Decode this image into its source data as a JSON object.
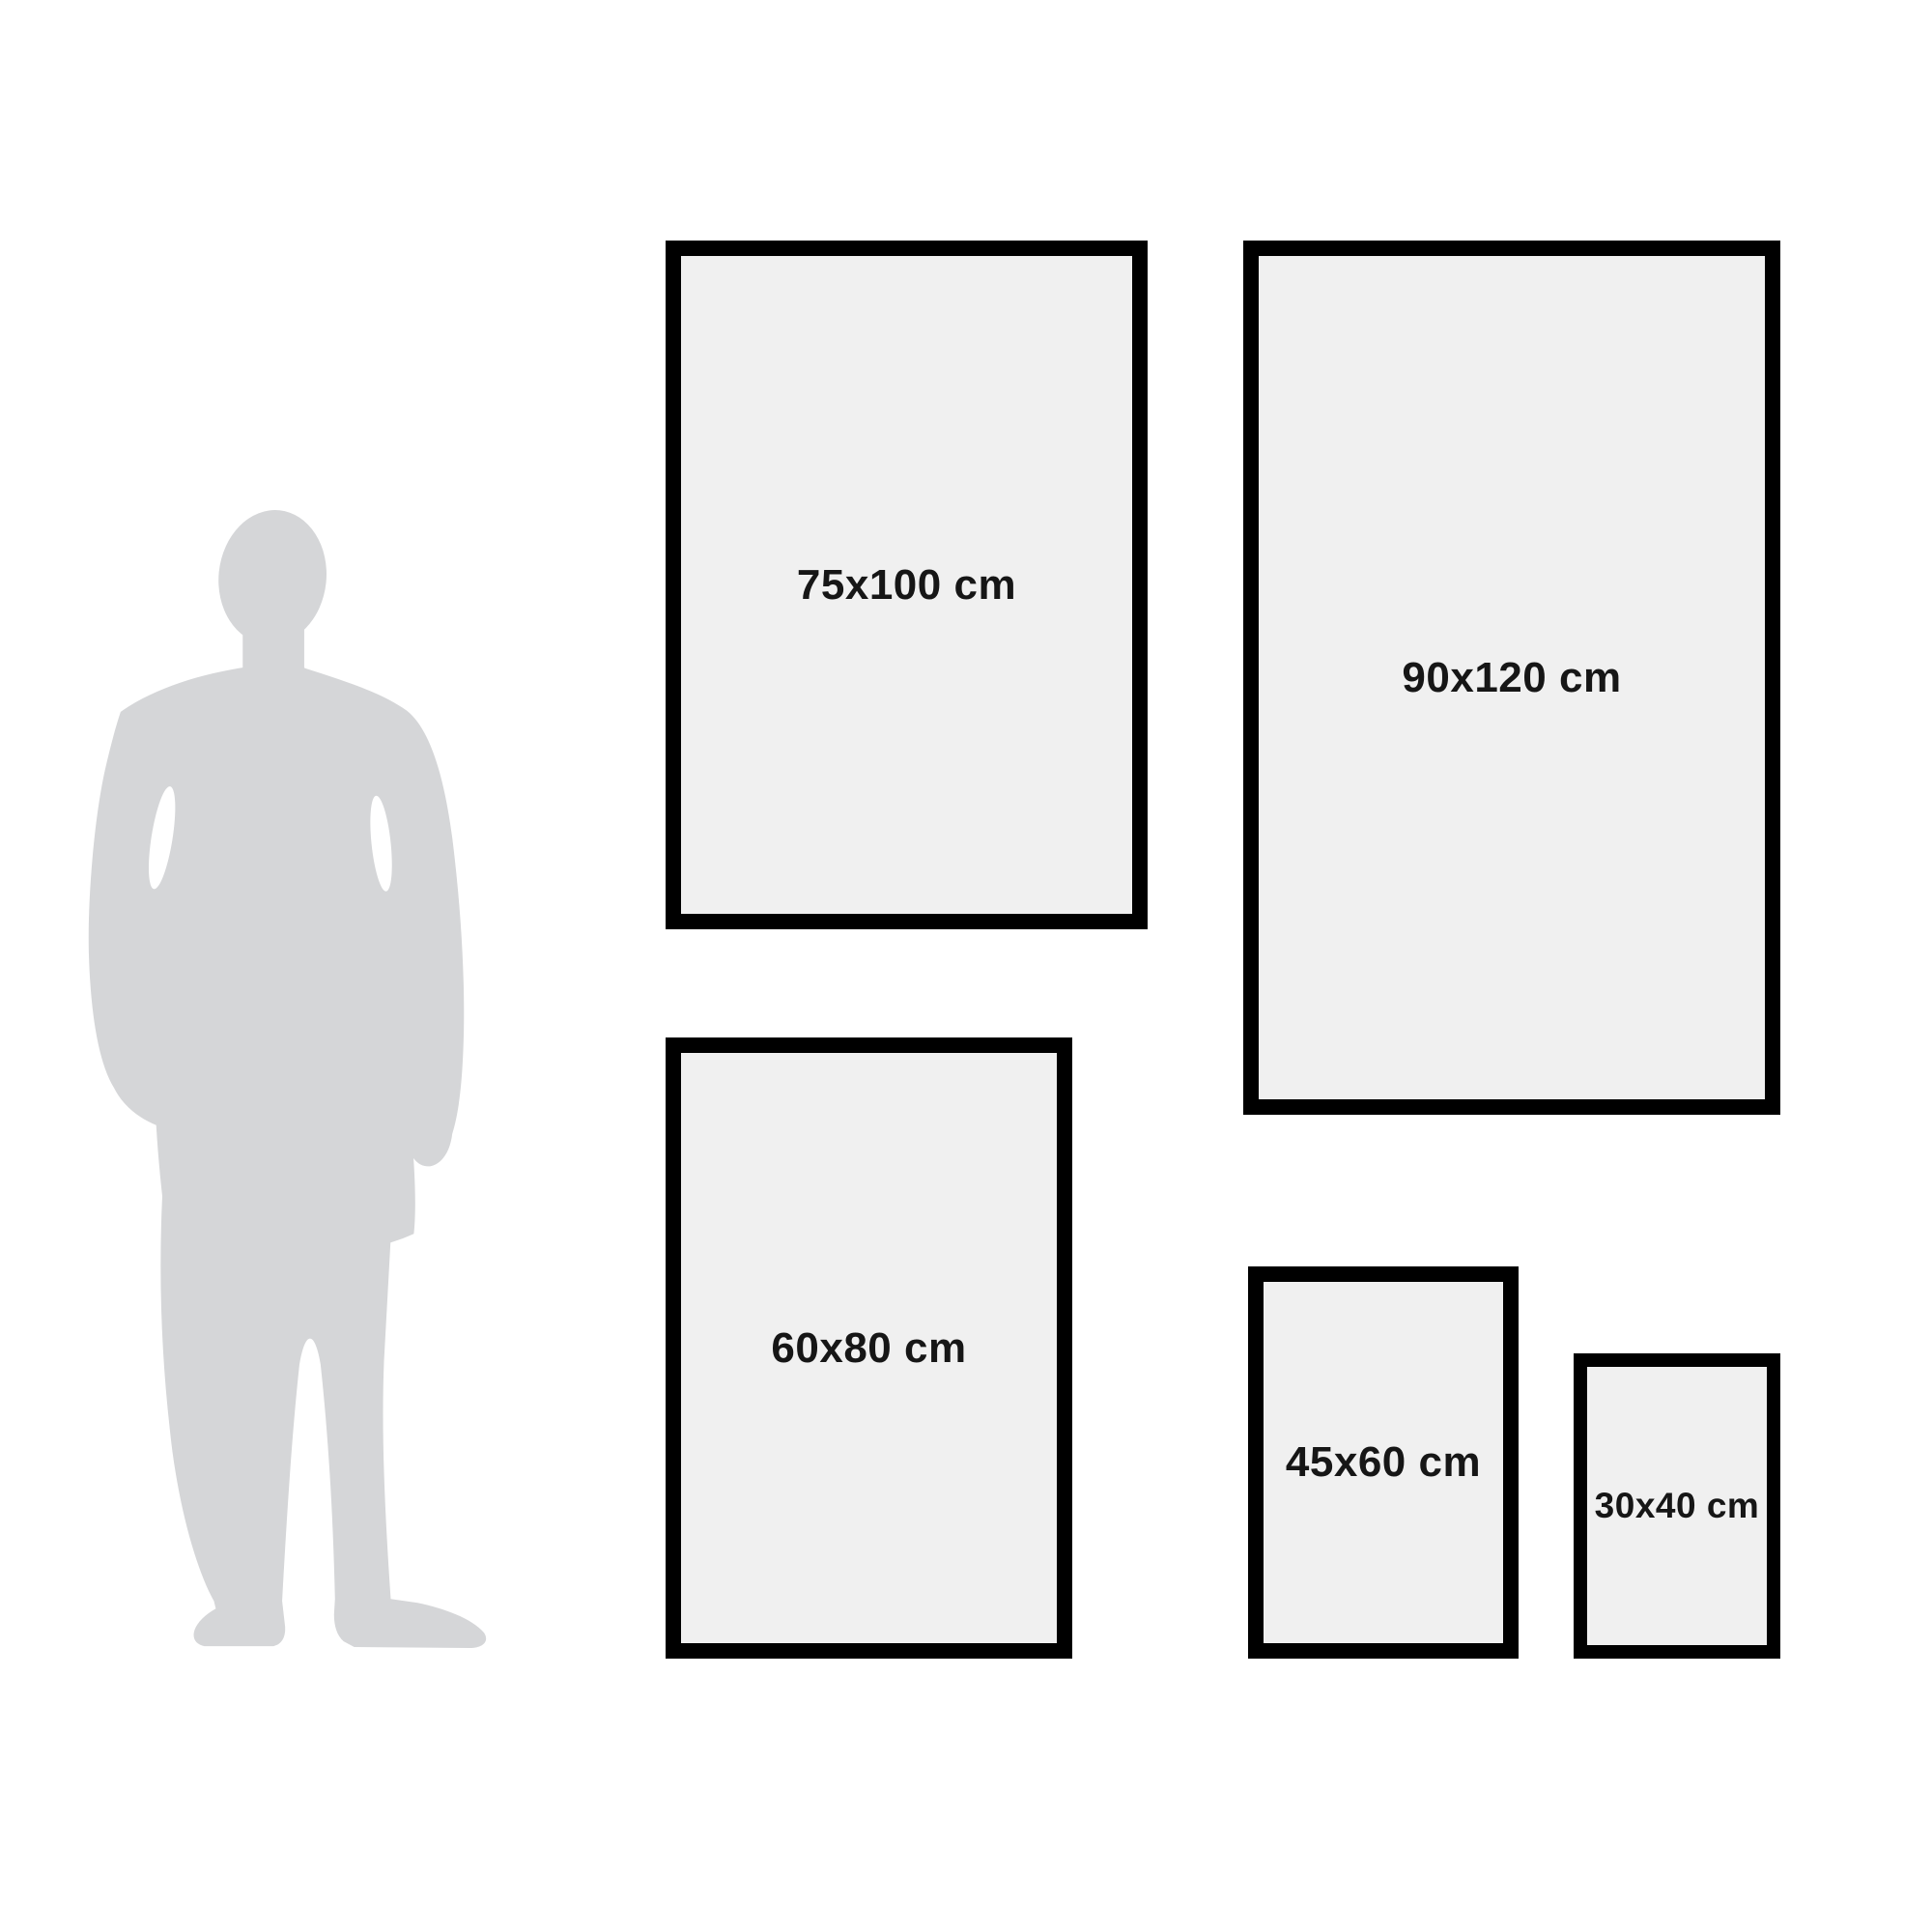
{
  "diagram": {
    "kind": "poster-frame-size-comparison",
    "frames": [
      {
        "id": "75x100",
        "label": "75x100 cm"
      },
      {
        "id": "90x120",
        "label": "90x120 cm"
      },
      {
        "id": "60x80",
        "label": "60x80 cm"
      },
      {
        "id": "45x60",
        "label": "45x60 cm"
      },
      {
        "id": "30x40",
        "label": "30x40 cm"
      }
    ]
  },
  "colors": {
    "background": "#ffffff",
    "frame_border": "#000000",
    "frame_fill": "#f0f0f0",
    "silhouette": "#d5d6d8",
    "label_text": "#161616"
  }
}
